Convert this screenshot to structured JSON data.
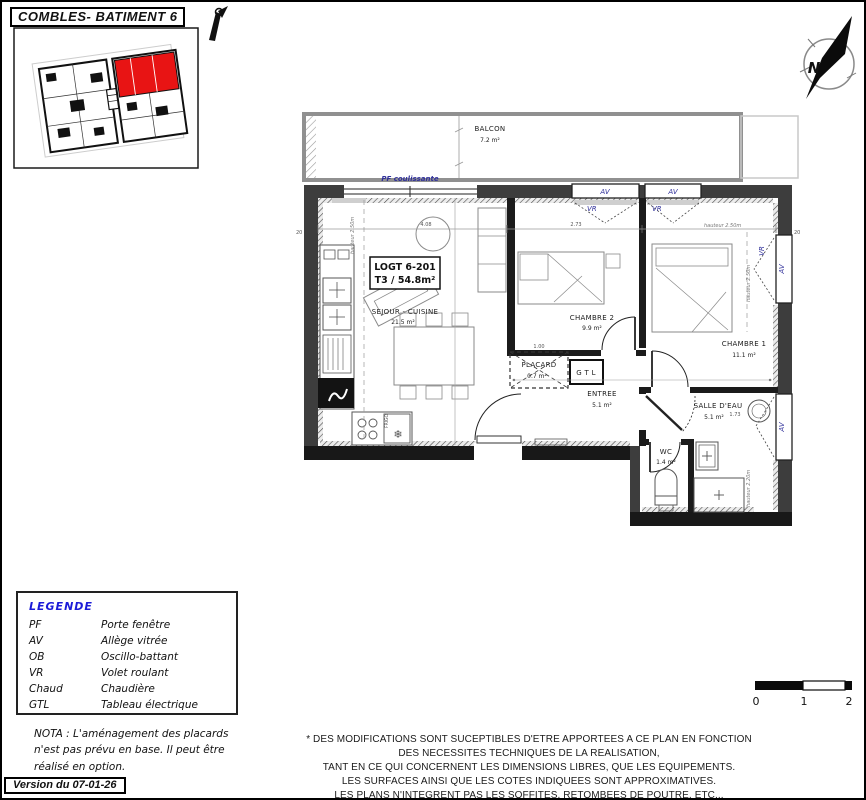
{
  "header": {
    "title": "COMBLES- BATIMENT 6"
  },
  "north": {
    "label": "N"
  },
  "key_plan": {
    "highlight_color": "#e81414"
  },
  "plan": {
    "unit": {
      "id": "LOGT 6-201",
      "type_area": "T3 / 54.8m²"
    },
    "rooms": {
      "balcon": {
        "name": "BALCON",
        "area": "7.2 m²"
      },
      "sejour": {
        "name": "SEJOUR - CUISINE",
        "area": "21.5 m²"
      },
      "chambre2": {
        "name": "CHAMBRE 2",
        "area": "9.9 m²"
      },
      "chambre1": {
        "name": "CHAMBRE 1",
        "area": "11.1 m²"
      },
      "entree": {
        "name": "ENTREE",
        "area": "5.1 m²"
      },
      "placard": {
        "name": "PLACARD",
        "area": "0.7 m²"
      },
      "salle_deau": {
        "name": "SALLE D'EAU",
        "area": "5.1 m²"
      },
      "wc": {
        "name": "WC",
        "area": "1.4 m²"
      }
    },
    "annotations": {
      "pf_coulissante": "PF coulissante",
      "av": "AV",
      "vr": "VR",
      "gtl": "G T L",
      "frigo": "FRIGO",
      "hauteur_250": "hauteur 2.50m",
      "hauteur_220": "hauteur 2.20m",
      "dim_408": "4.08",
      "dim_273": "2.73",
      "dim_100": "1.00",
      "dim_173": "1.73",
      "dim_20": "20"
    }
  },
  "legend": {
    "title": "LEGENDE",
    "entries": [
      {
        "code": "PF",
        "label": "Porte fenêtre"
      },
      {
        "code": "AV",
        "label": "Allège vitrée"
      },
      {
        "code": "OB",
        "label": "Oscillo-battant"
      },
      {
        "code": "VR",
        "label": "Volet roulant"
      },
      {
        "code": "Chaud",
        "label": "Chaudière"
      },
      {
        "code": "GTL",
        "label": "Tableau électrique"
      }
    ]
  },
  "nota": {
    "lines": [
      "NOTA : L'aménagement des placards",
      "n'est pas prévu en base. Il peut être",
      "réalisé en option."
    ]
  },
  "version": {
    "label": "Version du 07-01-26"
  },
  "disclaimer": {
    "lines": [
      "* DES MODIFICATIONS SONT SUCEPTIBLES D'ETRE APPORTEES A CE PLAN EN FONCTION",
      "DES NECESSITES TECHNIQUES DE LA REALISATION,",
      "TANT EN CE QUI CONCERNENT LES DIMENSIONS LIBRES, QUE LES EQUIPEMENTS.",
      "LES SURFACES AINSI QUE LES COTES INDIQUEES SONT APPROXIMATIVES.",
      "LES PLANS N'INTEGRENT PAS LES SOFFITES, RETOMBEES DE POUTRE, ETC..."
    ]
  },
  "scale_bar": {
    "labels": [
      "0",
      "1",
      "2"
    ]
  }
}
